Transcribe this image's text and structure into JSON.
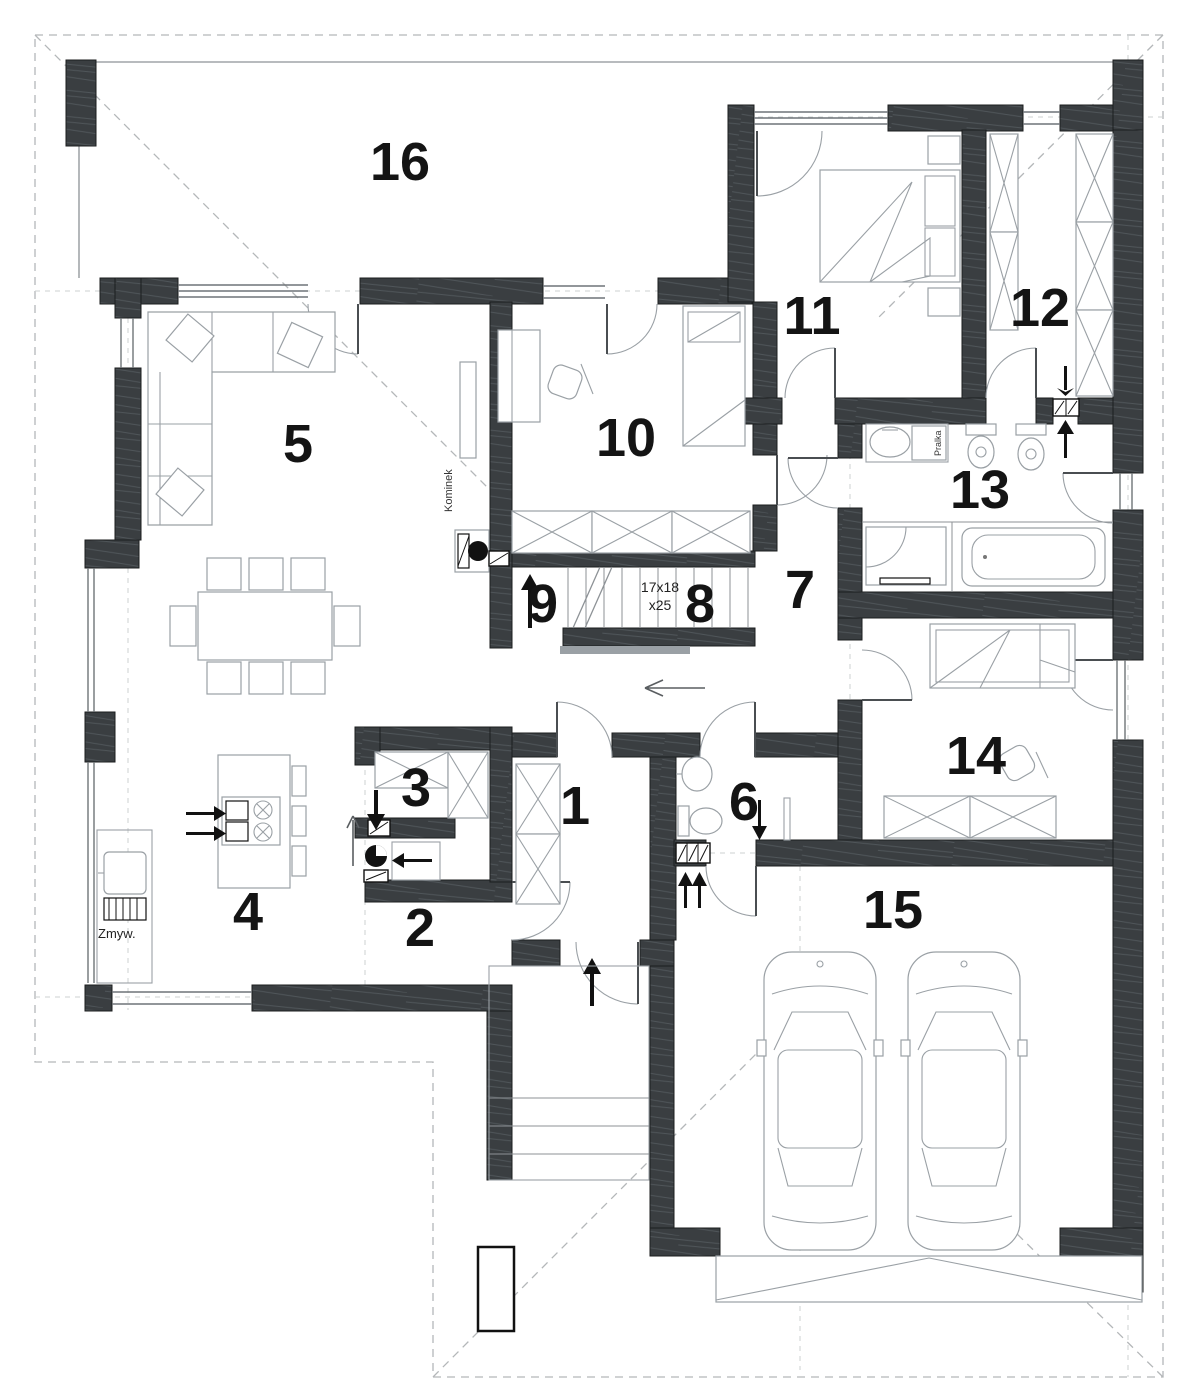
{
  "plan": {
    "rooms": [
      {
        "id": "room-1",
        "number": "1"
      },
      {
        "id": "room-2",
        "number": "2"
      },
      {
        "id": "room-3",
        "number": "3"
      },
      {
        "id": "room-4",
        "number": "4"
      },
      {
        "id": "room-5",
        "number": "5"
      },
      {
        "id": "room-6",
        "number": "6"
      },
      {
        "id": "room-7",
        "number": "7"
      },
      {
        "id": "room-8",
        "number": "8"
      },
      {
        "id": "room-9",
        "number": "9"
      },
      {
        "id": "room-10",
        "number": "10"
      },
      {
        "id": "room-11",
        "number": "11"
      },
      {
        "id": "room-12",
        "number": "12"
      },
      {
        "id": "room-13",
        "number": "13"
      },
      {
        "id": "room-14",
        "number": "14"
      },
      {
        "id": "room-15",
        "number": "15"
      },
      {
        "id": "room-16",
        "number": "16"
      }
    ],
    "labels": {
      "fireplace": "Kominek",
      "dishwasher": "Zmyw.",
      "washing_machine": "Pralka",
      "stairs_dim_1": "17x18",
      "stairs_dim_2": "x25"
    },
    "colors": {
      "wall": "#3a3e41",
      "wall_outline": "#1b1d1e",
      "thin_line": "#8d9296",
      "furniture_line": "#9aa0a5",
      "roof_dash": "#b4b7b9",
      "axis_dash": "#cdd0d1",
      "label_text": "#141414",
      "background": "#ffffff"
    }
  }
}
